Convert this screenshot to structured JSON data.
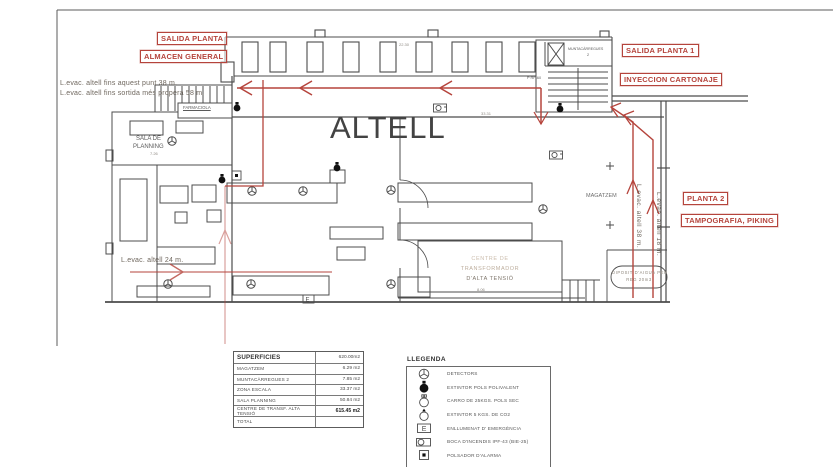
{
  "colors": {
    "route_red": "#b5443c",
    "line_gray": "#4c4c4c",
    "faded_text": "#bdae9e",
    "note_text": "#6f675e"
  },
  "title": {
    "main": "ALTELL"
  },
  "red_labels": {
    "salida_planta": "SALIDA PLANTA",
    "almacen_general": "ALMACEN GENERAL",
    "salida_planta_1": "SALIDA PLANTA 1",
    "inyeccion_cartonaje": "INYECCION CARTONAJE",
    "planta_2": "PLANTA 2",
    "tampografia_piking": "TAMPOGRAFIA, PIKING"
  },
  "annotations": {
    "evac_note_line1": "L.evac. altell fins aquest punt 38 m.",
    "evac_note_line2": "L.evac. altell fins sortida més propera 58 m.",
    "evac_24": "L.evac. altell  24 m.",
    "evac_38": "L.evac. altell  38 m.",
    "evac_18": "L.evac. altell  18 m."
  },
  "rooms": {
    "sala_planning_l1": "SALA DE",
    "sala_planning_l2": "PLANNING",
    "farmaciola": "FARMACIOLA",
    "magatzem": "MAGATZEM",
    "muntacarregues_l1": "MUNTACÀRREGUES",
    "muntacarregues_l2": "2",
    "rf60": "P RF-60",
    "transformador_l1": "CENTRE DE",
    "transformador_l2": "TRANSFORMADOR",
    "transformador_l3": "D'ALTA TENSIÓ",
    "diposit_l1": "DIPOSIT D'AIGUA PER",
    "diposit_l2": "REG 20m3"
  },
  "dimensions": {
    "d1": "22.30",
    "d2": "33.31",
    "d3": "7.26",
    "d4": "8.06"
  },
  "superficies": {
    "title": "SUPERFICIES",
    "title_value": "620.00m2",
    "rows": [
      {
        "label": "MAGATZEM",
        "value": "6.29 m2"
      },
      {
        "label": "MUNTACÀRREGUES 2",
        "value": "7.85 m2"
      },
      {
        "label": "ZONA ESCALA",
        "value": "33.37 m2"
      },
      {
        "label": "SALA PLANNING",
        "value": "50.84 m2"
      },
      {
        "label": "CENTRE DE TRANSF. ALTA TENSIÓ",
        "value": "615.45 m2"
      },
      {
        "label": "TOTAL",
        "value": ""
      }
    ]
  },
  "legend": {
    "title": "LLEGENDA",
    "items": [
      {
        "name": "detectors",
        "label": "DETECTORS"
      },
      {
        "name": "extintor-pols",
        "label": "EXTINTOR POLS POLIVALENT"
      },
      {
        "name": "carro-pols",
        "label": "CARRO DE 25KGS. POLS SEC"
      },
      {
        "name": "extintor-co2",
        "label": "EXTINTOR 5 KGS. DE CO2"
      },
      {
        "name": "enllumenat",
        "label": "ENLLUMENAT D' EMERGÈNCIA"
      },
      {
        "name": "boca-incendis",
        "label": "BOCA D'INCENDIS IPF-43 (BIE-25)"
      },
      {
        "name": "polsador",
        "label": "POLSADOR D'ALARMA"
      }
    ]
  },
  "icon_glyphs": {
    "emergency_light": "E"
  }
}
